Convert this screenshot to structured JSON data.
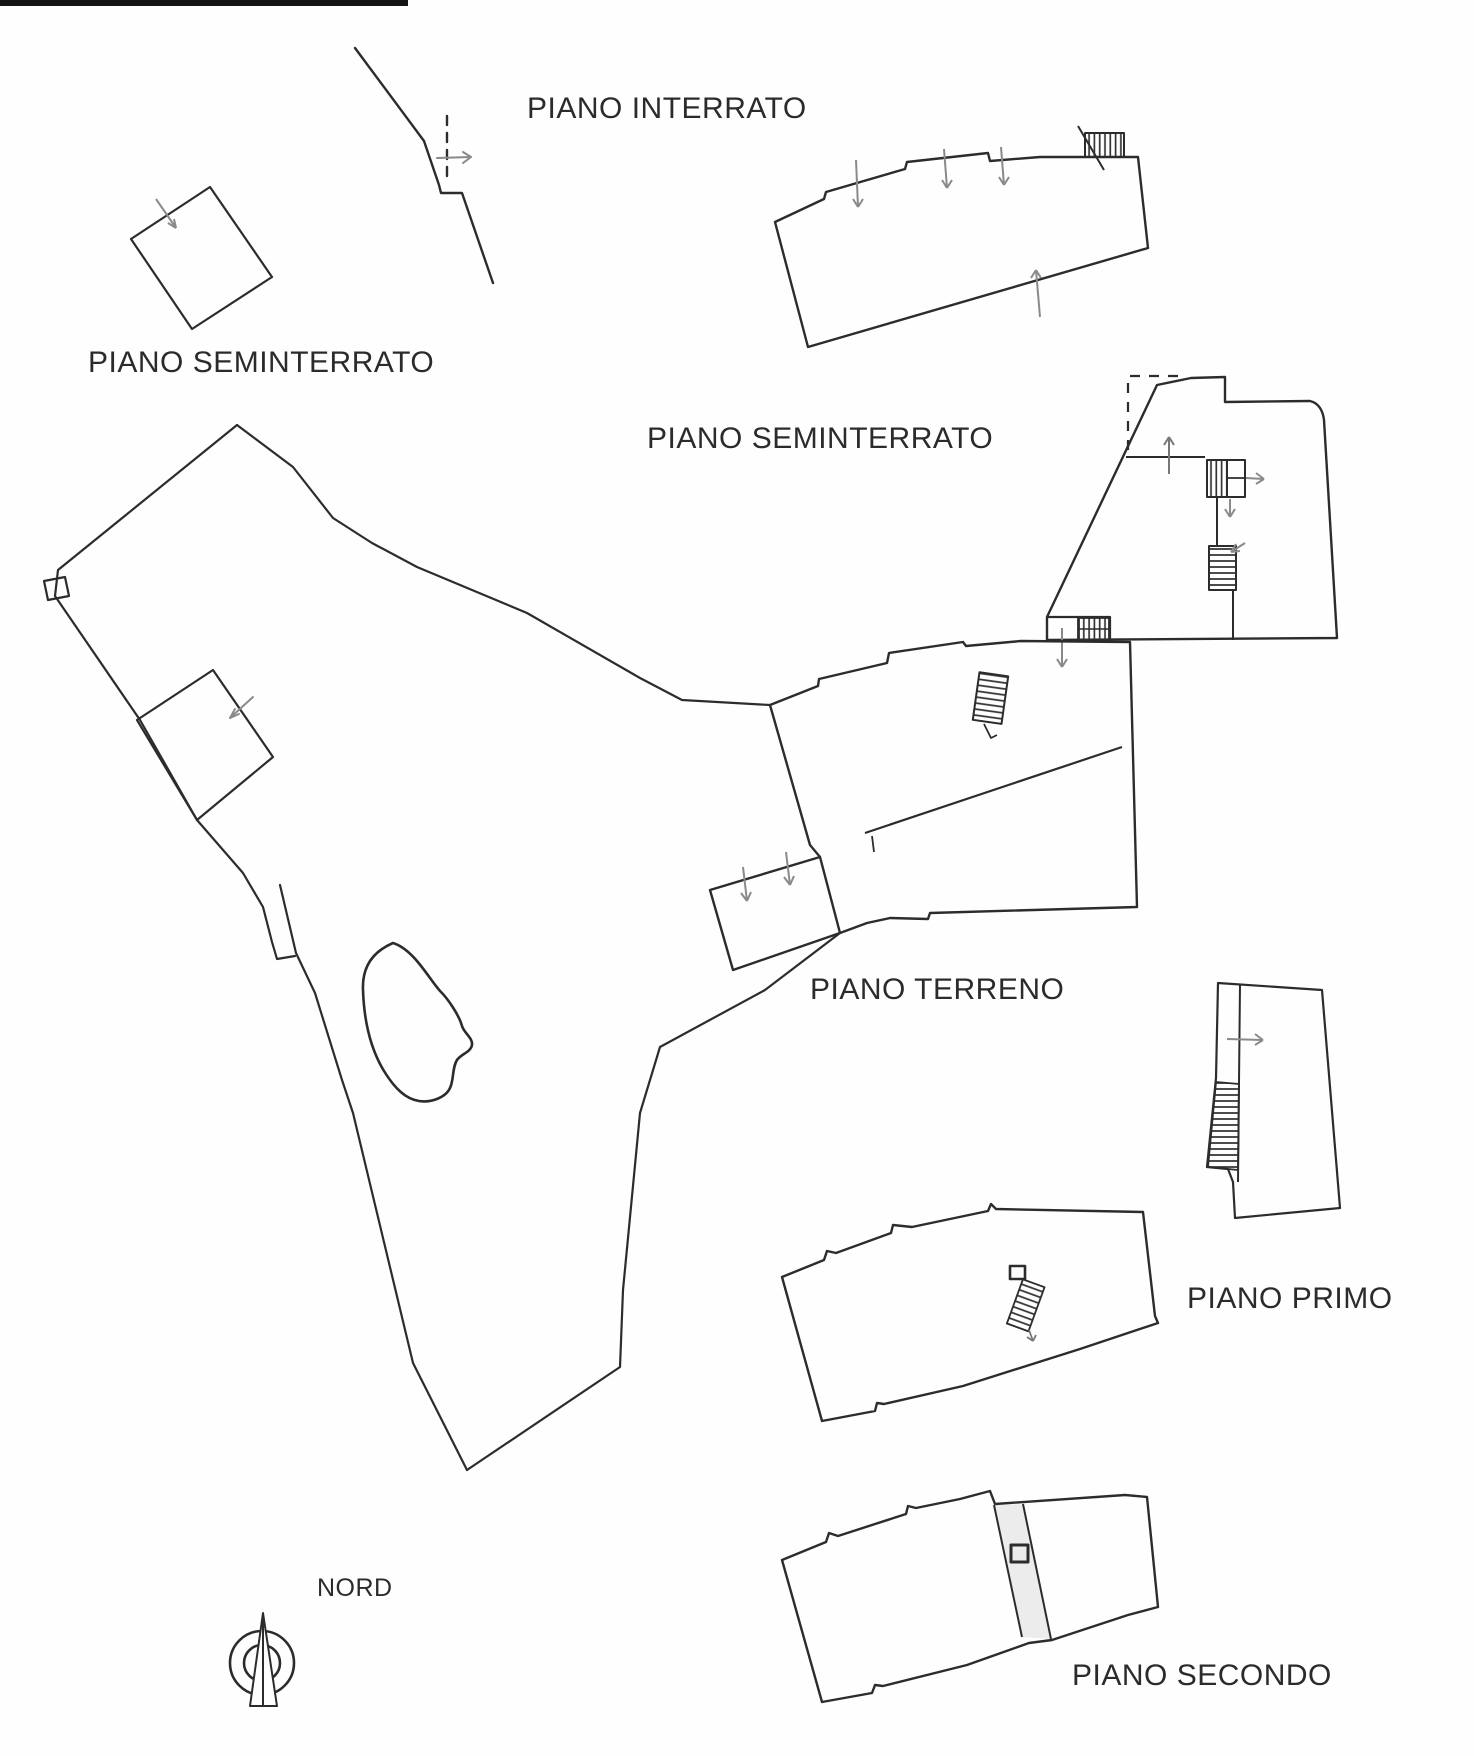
{
  "document": {
    "type": "cadastral-floor-plan-sketch",
    "language": "it"
  },
  "labels": {
    "piano_interrato": "PIANO INTERRATO",
    "piano_seminterrato_left": "PIANO SEMINTERRATO",
    "piano_seminterrato_right": "PIANO SEMINTERRATO",
    "piano_terreno": "PIANO TERRENO",
    "piano_primo": "PIANO PRIMO",
    "piano_secondo": "PIANO SECONDO",
    "nord": "NORD"
  },
  "colors": {
    "ink": "#2c2c2c",
    "annotation_arrow": "#8a8a8a",
    "paper": "#fefefe",
    "scan_bar": "#141414",
    "strip_shading": "#ececec"
  }
}
